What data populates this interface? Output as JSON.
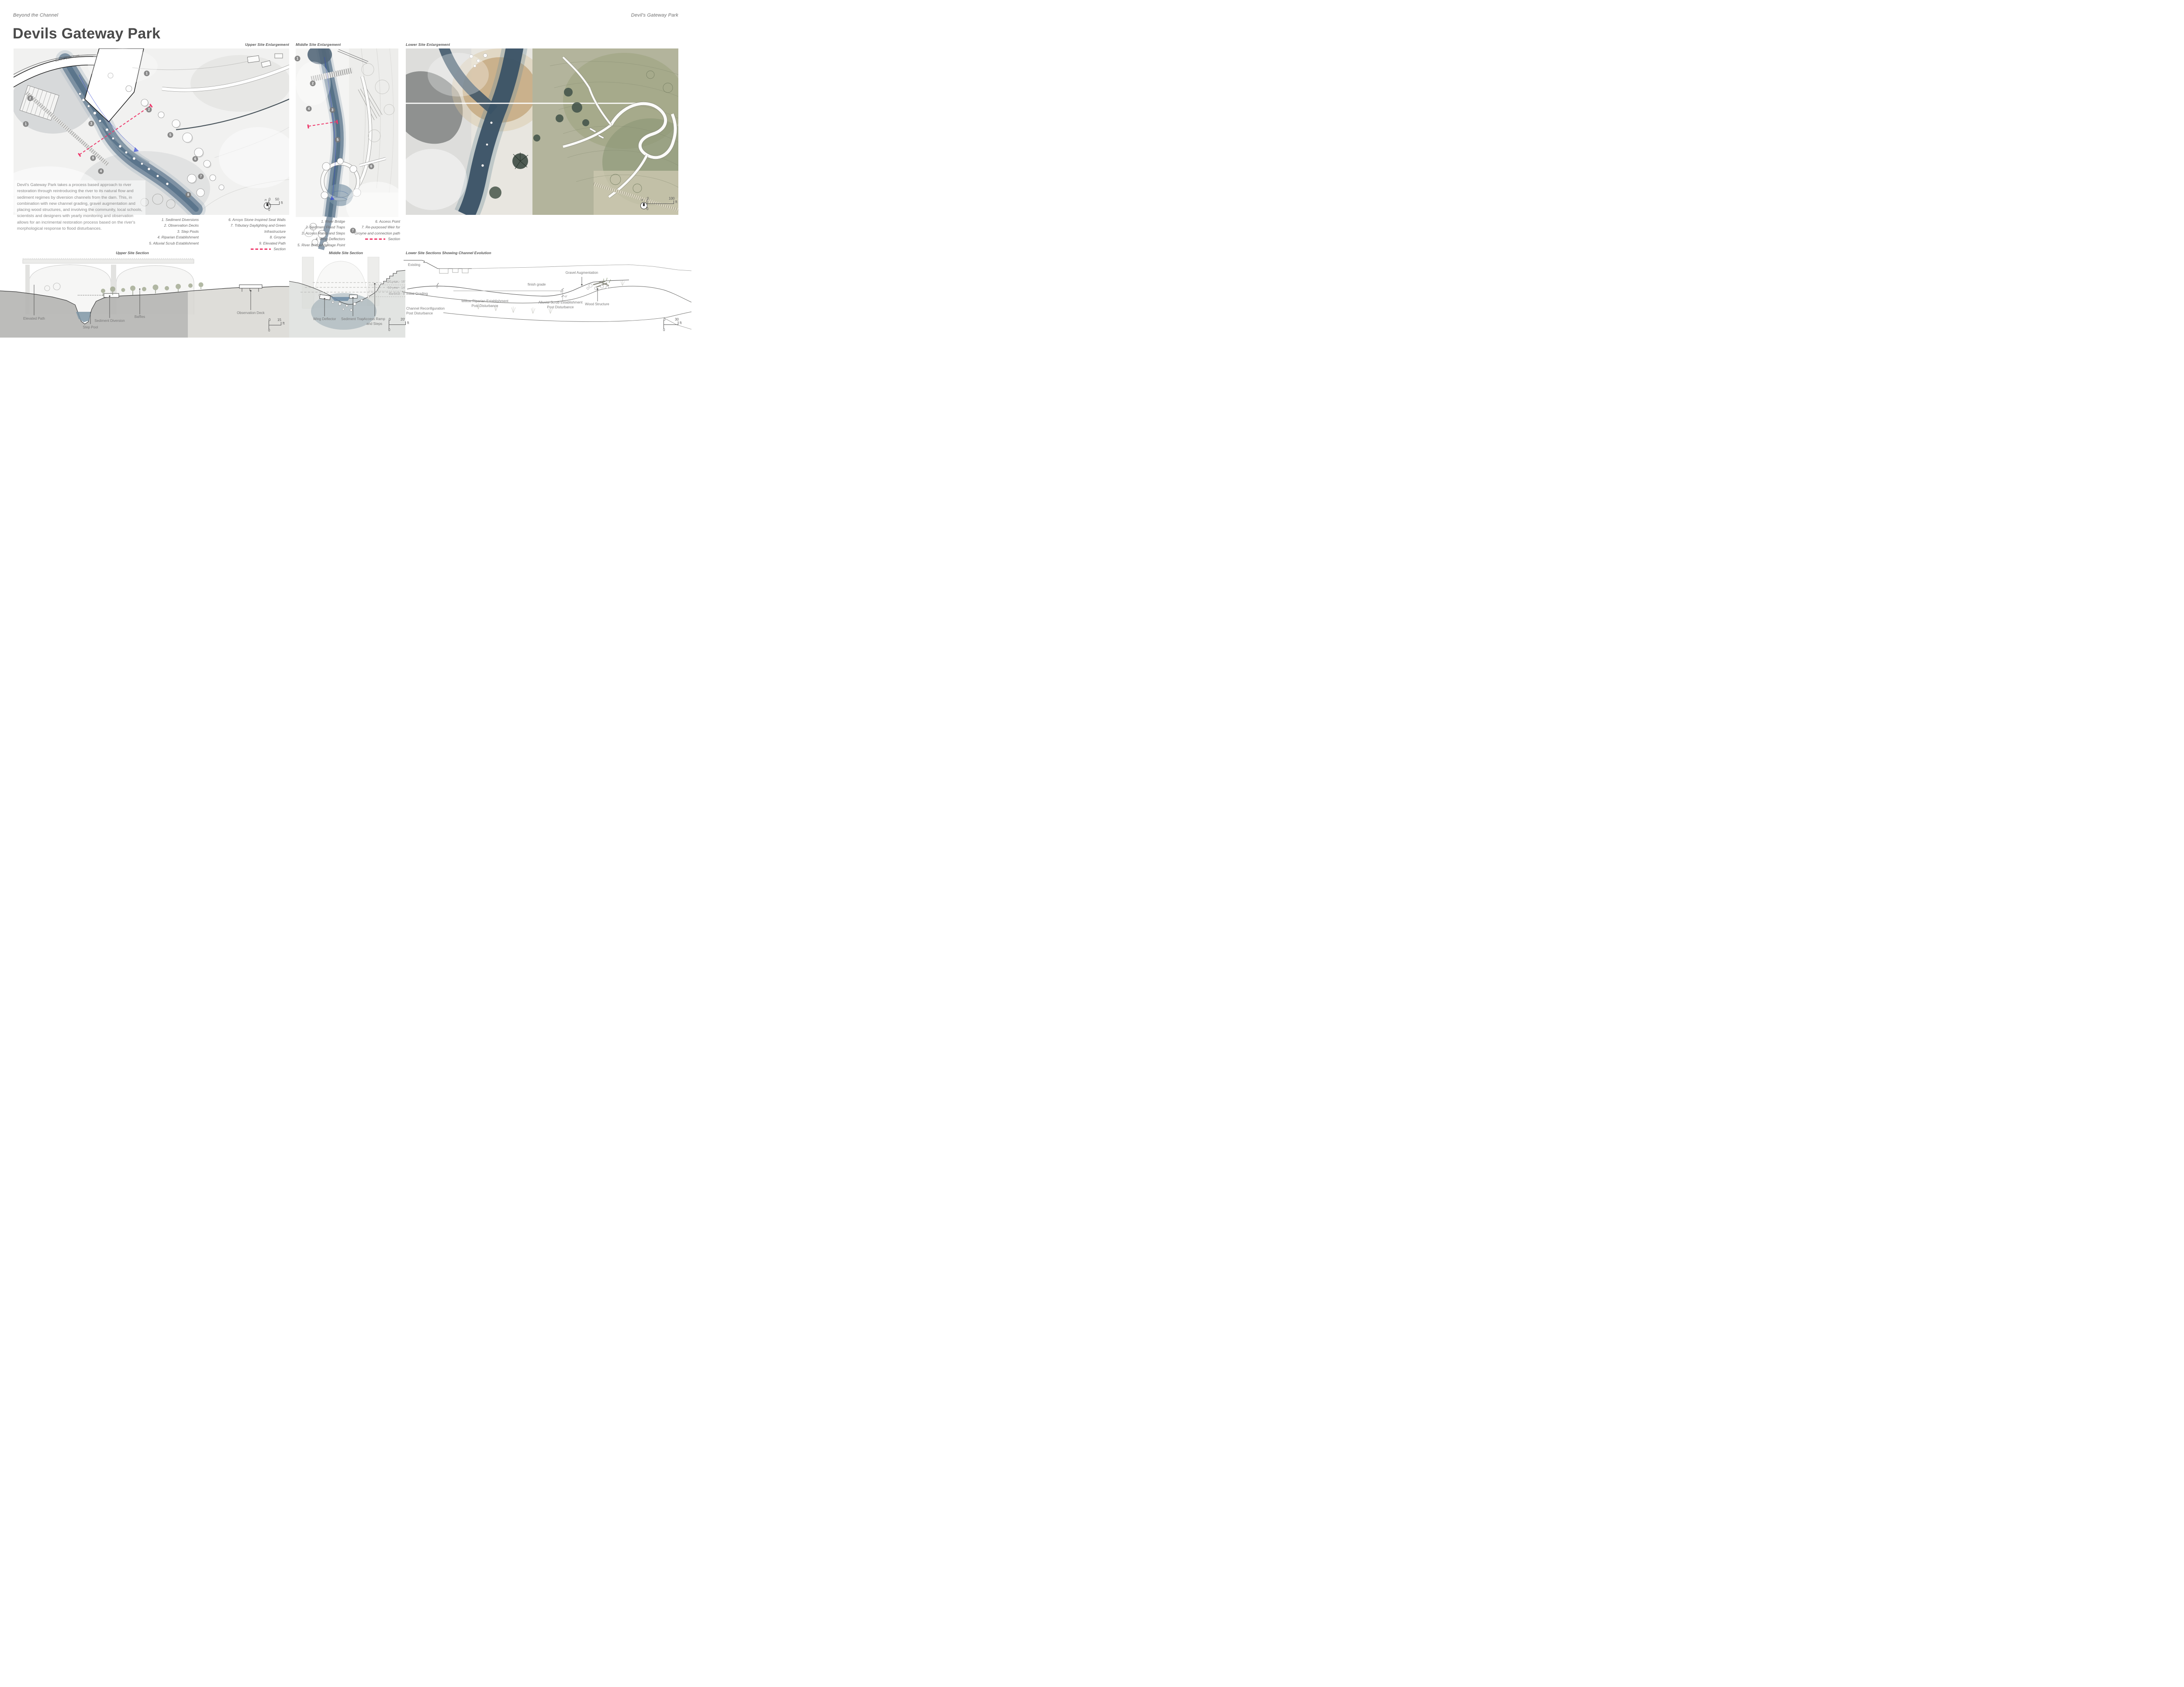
{
  "header": {
    "project": "Beyond the Channel",
    "project_right": "Devil's Gateway Park",
    "title": "Devils Gateway Park"
  },
  "panels": {
    "upper": {
      "label": "Upper Site Enlargement",
      "dam_label": "Devil's Gate Dam",
      "markers": [
        "1",
        "2",
        "2",
        "1",
        "3",
        "5",
        "9",
        "4",
        "6",
        "7",
        "8"
      ],
      "north_label": "n",
      "scale": {
        "zero_h": "0",
        "max": "50",
        "unit": "ft",
        "zero_v": "0"
      }
    },
    "middle": {
      "label": "Middle Site Enlargement",
      "markers": [
        "1",
        "2",
        "4",
        "3",
        "5",
        "6",
        "7"
      ]
    },
    "lower": {
      "label": "Lower Site Enlargement",
      "north_label": "n",
      "scale": {
        "zero_h": "0",
        "max": "100",
        "unit": "ft",
        "zero_v": "0"
      }
    }
  },
  "description": "Devil's Gateway Park takes a process based approach to river restoration through reintroducing the river to its natural flow and sediment regimes by diversion channels from the dam. This, in combination with new channel grading, gravel augmentation and placing wood structures, and involving the community, local schools, scientists and designers with yearly monitoring and observation allows for an incrimental restoration process based on the river's morphological response to flood disturbances.",
  "legend_upper": {
    "col1": [
      "1. Sediment Diversions",
      "2. Observation Decks",
      "3. Step Pools",
      "4. Riparian Establishment",
      "5. Alluvial Scrub Establishment"
    ],
    "col2": [
      "6. Arroyo Stone Inspired Seat Walls",
      "7. Tributary Daylighting and Green",
      "Infrastructure",
      "8. Groyne",
      "9. Elevated Path"
    ],
    "section_label": "Section"
  },
  "legend_middle": {
    "col1": [
      "1. River Bridge",
      "2. Sediment Flood Traps",
      "3. Access Ramp and Steps",
      "4. Wing Deflectors",
      "5. River Bridge/Vantage Point"
    ],
    "col2": [
      "6. Access Point",
      "7. Re-purposed Weir for",
      "Groyne and connection path"
    ],
    "section_label": "Section"
  },
  "sections": {
    "upper": {
      "title": "Upper Site Section",
      "labels": {
        "elevated_path": "Elevated Path",
        "step_pool": "Step Pool",
        "sediment_diversion": "Sediment Diversion",
        "baffles": "Baffles",
        "observation_deck": "Observation Deck"
      },
      "scale": {
        "zero_h": "0",
        "max": "15",
        "unit": "ft",
        "zero_v": "0"
      }
    },
    "middle": {
      "title": "Middle Site Section",
      "flood_levels": [
        "100 year - 16'",
        "50 year - 14'",
        "Bankfull - 8'"
      ],
      "labels": {
        "wing_deflector": "Wing Deflector",
        "sediment_trap": "Sediment Trap",
        "access_ramp_1": "Access Ramp",
        "access_ramp_2": "and Steps"
      },
      "scale": {
        "zero_h": "0",
        "max": "20'",
        "unit": "ft",
        "zero_v": "0"
      }
    },
    "lower": {
      "title": "Lower Site Sections Showing Channel Evolution",
      "stages": {
        "existing": "Existing",
        "initial_grading": "Initial Grading",
        "channel_reconfig_1": "Channel Reconfiguration",
        "channel_reconfig_2": "Post Disturbance"
      },
      "annotations": {
        "gravel": "Gravel Augmentation",
        "finish_grade": "finish grade",
        "willow_1": "Willow Riparian Establishment",
        "willow_2": "Post Disturbance",
        "alluvial_1": "Alluvial Scrub Establishment",
        "alluvial_2": "Post Disturbance",
        "wood": "Wood Structure",
        "dim_6a": "6'",
        "dim_6b": "6'",
        "dim_8": "+8'"
      },
      "scale": {
        "zero_h": "0",
        "max": "30",
        "unit": "ft",
        "zero_v": "0"
      }
    }
  },
  "colors": {
    "accent": "#ee3a6c",
    "river": "#70869a",
    "ink": "#4a4a4a"
  }
}
